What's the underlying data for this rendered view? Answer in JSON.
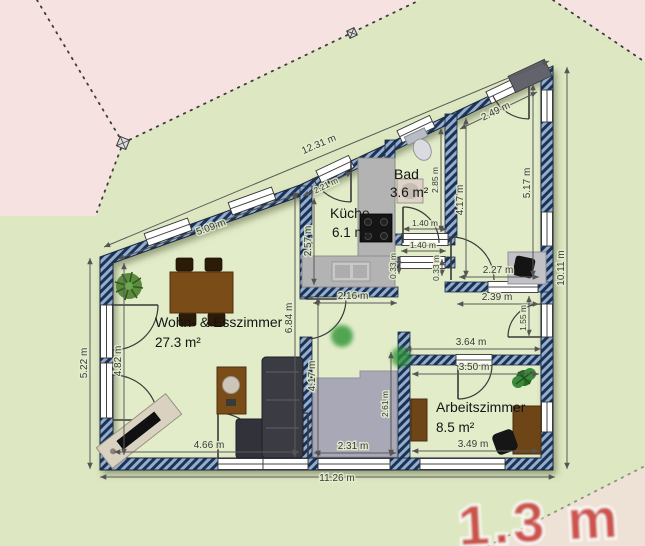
{
  "rooms": {
    "living": {
      "name": "Wohn- & Esszimmer",
      "area": "27.3 m²"
    },
    "kitchen": {
      "name": "Küche",
      "area": "6.1 m²"
    },
    "bath": {
      "name": "Bad",
      "area": "3.6 m²"
    },
    "office": {
      "name": "Arbeitszimmer",
      "area": "8.5 m²"
    }
  },
  "dimensions": {
    "roof_total": "12.31 m",
    "diag_left_inner": "5.09 m",
    "kitchen_diag": "2.21 m",
    "ne_diag": "2.49 m",
    "kitchen_left": "2.57 m",
    "bath_height": "2.85 m",
    "ne_left": "4.17 m",
    "ne_right": "5.17 m",
    "right_total": "10.11 m",
    "ne_width": "2.27 m",
    "nook_width": "2.39 m",
    "nook_door": "1.55 m",
    "office_outer_width": "3.64 m",
    "office_inner_width": "3.50 m",
    "office_bottom_width": "3.49 m",
    "bottom_total": "11.26 m",
    "left_outer": "5.22 m",
    "left_inner": "4.82 m",
    "living_bottom": "4.66 m",
    "living_height": "6.84 m",
    "hall_width": "2.16 m",
    "bed_left": "4.17 m",
    "bed_width": "2.31 m",
    "bed_height": "2.61 m",
    "bath_door": "1.40 m",
    "hall_door": "1.40 m",
    "stub_a": "0.33 m",
    "stub_b": "0.33 m"
  },
  "watermark": {
    "label": "1.3 m"
  },
  "colors": {
    "wall_fill": "#93aecb",
    "wall_stripe": "#1d3157",
    "floor": "#e3ecc9",
    "lot_green": "#dde7c1",
    "neighbor_pink": "#f6e2e0",
    "dimension_text": "#3a3a3a",
    "watermark_red": "#c93a36"
  }
}
